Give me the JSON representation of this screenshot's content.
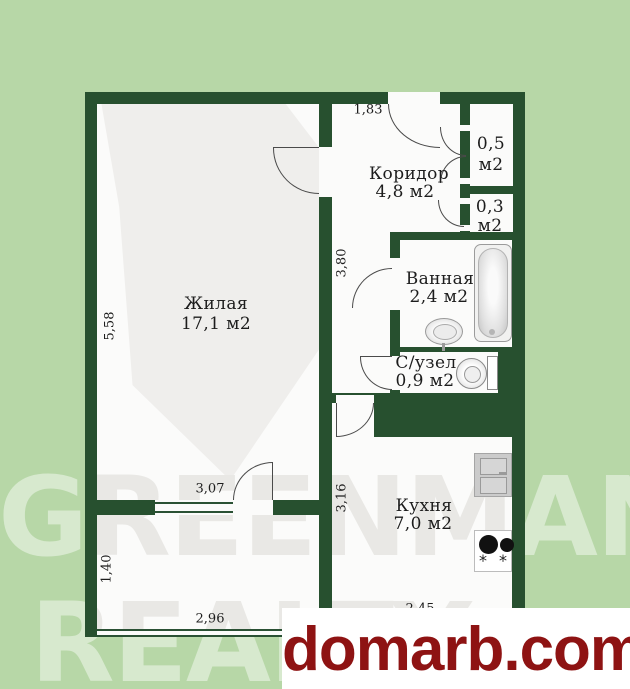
{
  "watermark": {
    "line1": "GREENMAN",
    "line2": "REALTY"
  },
  "footer": {
    "site": "domarb.com"
  },
  "rooms": {
    "living": {
      "name": "Жилая",
      "area": "17,1 м2"
    },
    "corridor": {
      "name": "Коридор",
      "area": "4,8 м2"
    },
    "bathroom": {
      "name": "Ванная",
      "area": "2,4 м2"
    },
    "wc": {
      "name": "С/узел",
      "area": "0,9 м2"
    },
    "kitchen": {
      "name": "Кухня",
      "area": "7,0 м2"
    },
    "closet_large": {
      "value": "0,5",
      "unit": "м2"
    },
    "closet_small": {
      "value": "0,3",
      "unit": "м2"
    }
  },
  "dimensions": {
    "entry_top": "1,83",
    "living_height": "5,58",
    "corridor_height": "3,80",
    "living_width": "3,07",
    "kitchen_height": "3,16",
    "balcony_height": "1,40",
    "balcony_width": "2,96",
    "kitchen_width": "2,45"
  },
  "icons": {
    "burner_glyph": "*"
  },
  "colors": {
    "background": "#b7d7a7",
    "wall_green": "#27502f",
    "floor_white": "#fbfbfa",
    "watermark_gray": "#e9e8e5",
    "brand_red": "#8e1313"
  }
}
